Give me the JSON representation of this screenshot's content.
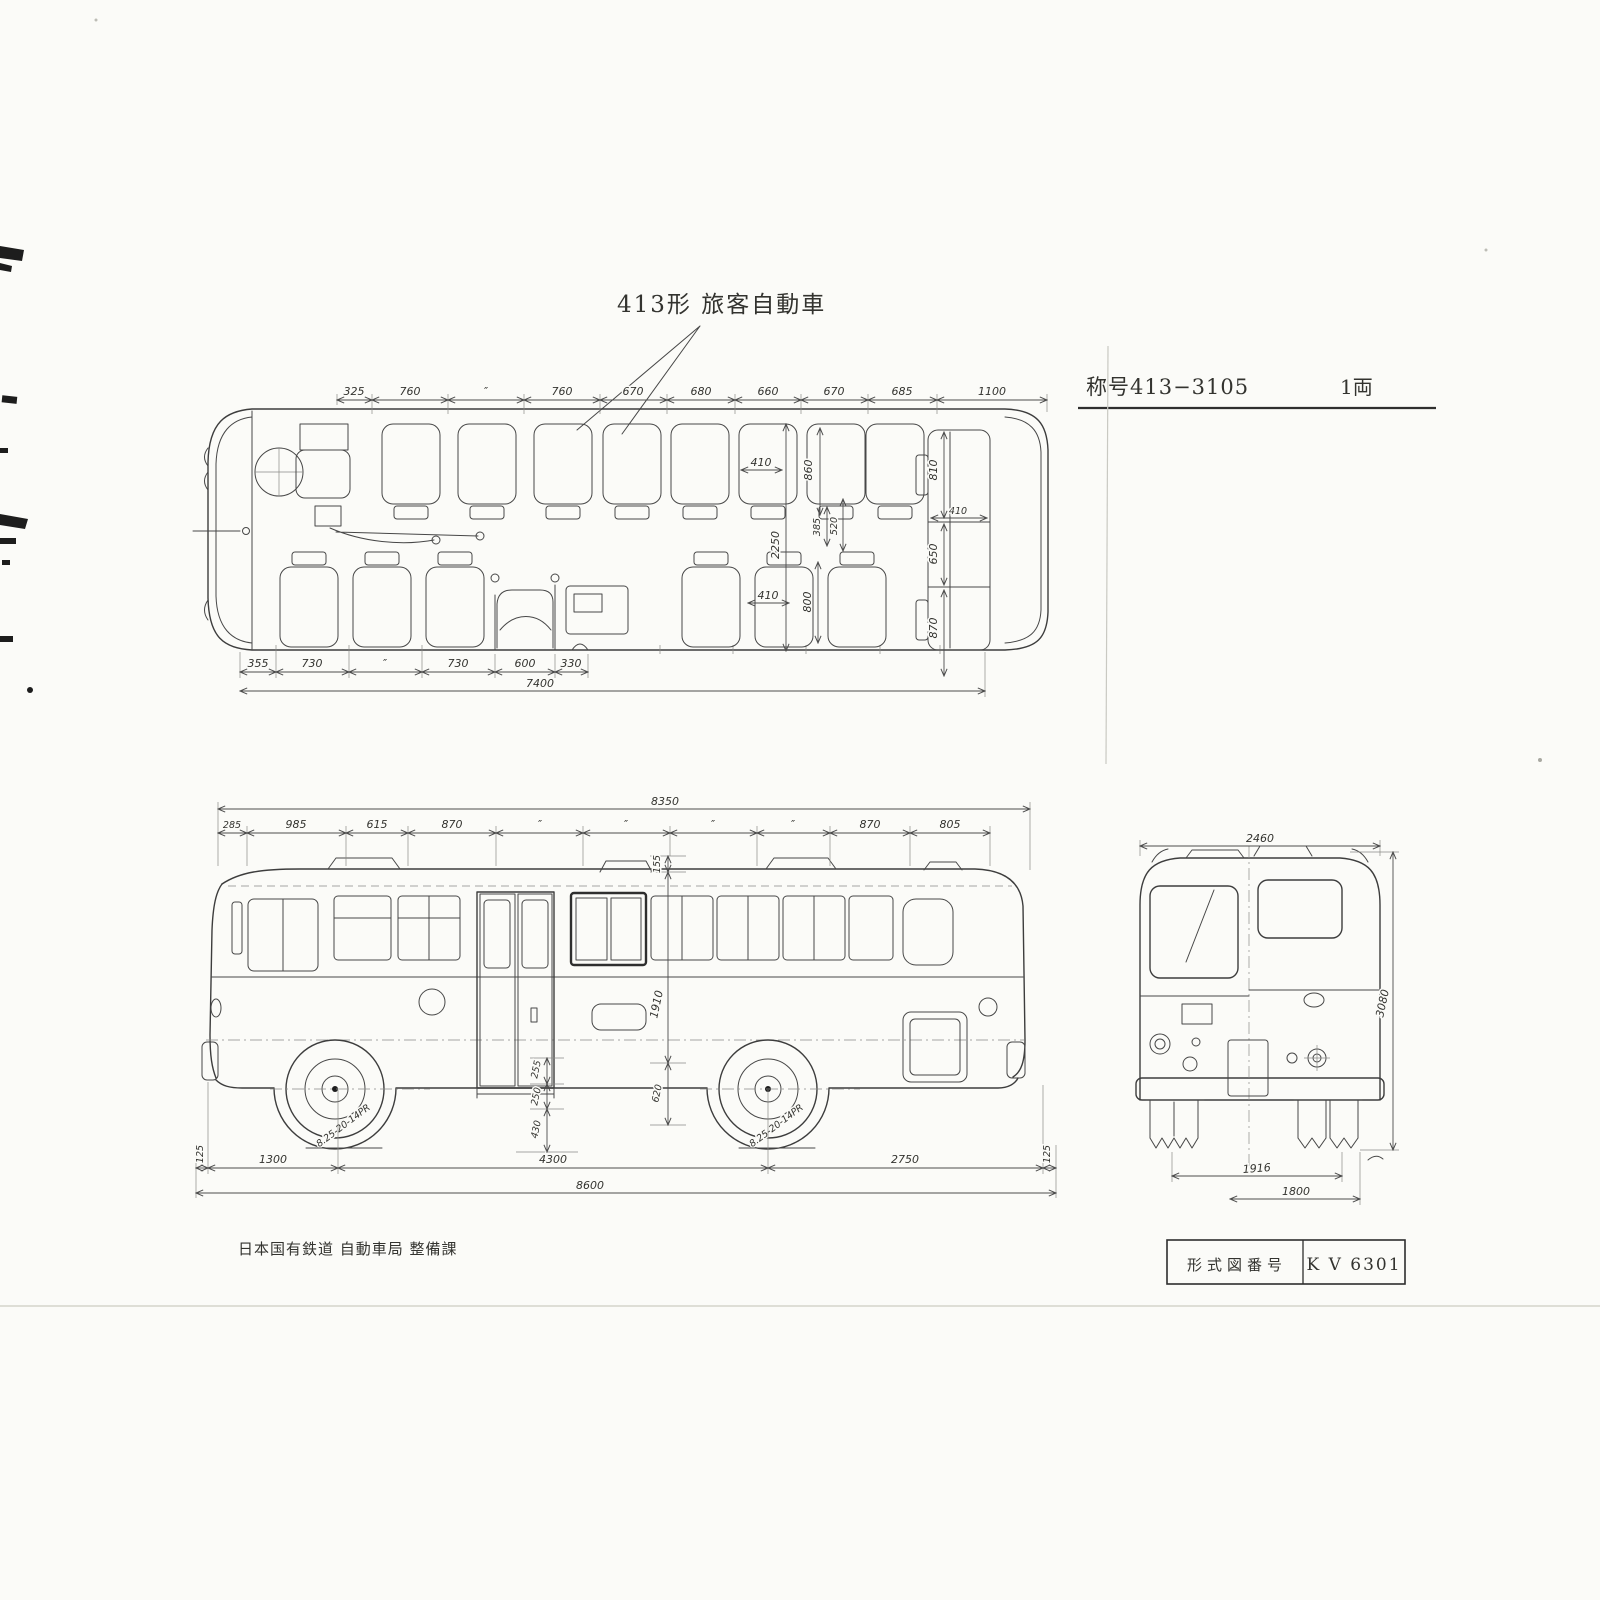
{
  "document": {
    "title": "413形  旅客自動車",
    "designation_label": "称号413−3105",
    "quantity": "1両",
    "footer_org": "日本国有鉄道  自動車局  整備課",
    "title_block": {
      "label": "形式図番号",
      "value": "K V 6301"
    }
  },
  "plan_view": {
    "dims_top": [
      "325",
      "760",
      "″",
      "760",
      "670",
      "680",
      "660",
      "670",
      "685",
      "1100"
    ],
    "dims_bottom": [
      "355",
      "730",
      "″",
      "730",
      "600",
      "330"
    ],
    "dim_overall_interior": "7400",
    "dim_seat_width_front": "410",
    "dim_seat_pitch": "860",
    "dim_bench_side_upper": "810",
    "dim_interior_width": "2250",
    "dim_aisle_gap_a": "385",
    "dim_aisle_gap_b": "520",
    "dim_seat_width_rear": "410",
    "dim_seat_cushion_rear": "800",
    "dim_bench_depth": "410",
    "dim_bench_center": "650",
    "dim_bench_side_lower": "870"
  },
  "side_view": {
    "dim_overall_top": "8350",
    "dims_top": [
      "285",
      "985",
      "615",
      "870",
      "″",
      "″",
      "″",
      "″",
      "870",
      "805"
    ],
    "dim_vent_height": "155",
    "dim_body_height": "1910",
    "dim_skirt_height": "620",
    "dim_step_top": "255",
    "dim_step_mid": "250",
    "dim_step_bottom": "430",
    "dim_front_margin": "125",
    "dim_front_axle": "1300",
    "dim_wheelbase": "4300",
    "dim_rear_overhang": "2750",
    "dim_rear_margin": "125",
    "dim_overall_length": "8600",
    "tire_size": "8.25-20-14PR"
  },
  "front_view": {
    "dim_overall_width": "2460",
    "dim_overall_height": "3080",
    "dim_front_track": "1916",
    "dim_rear_track": "1800"
  }
}
